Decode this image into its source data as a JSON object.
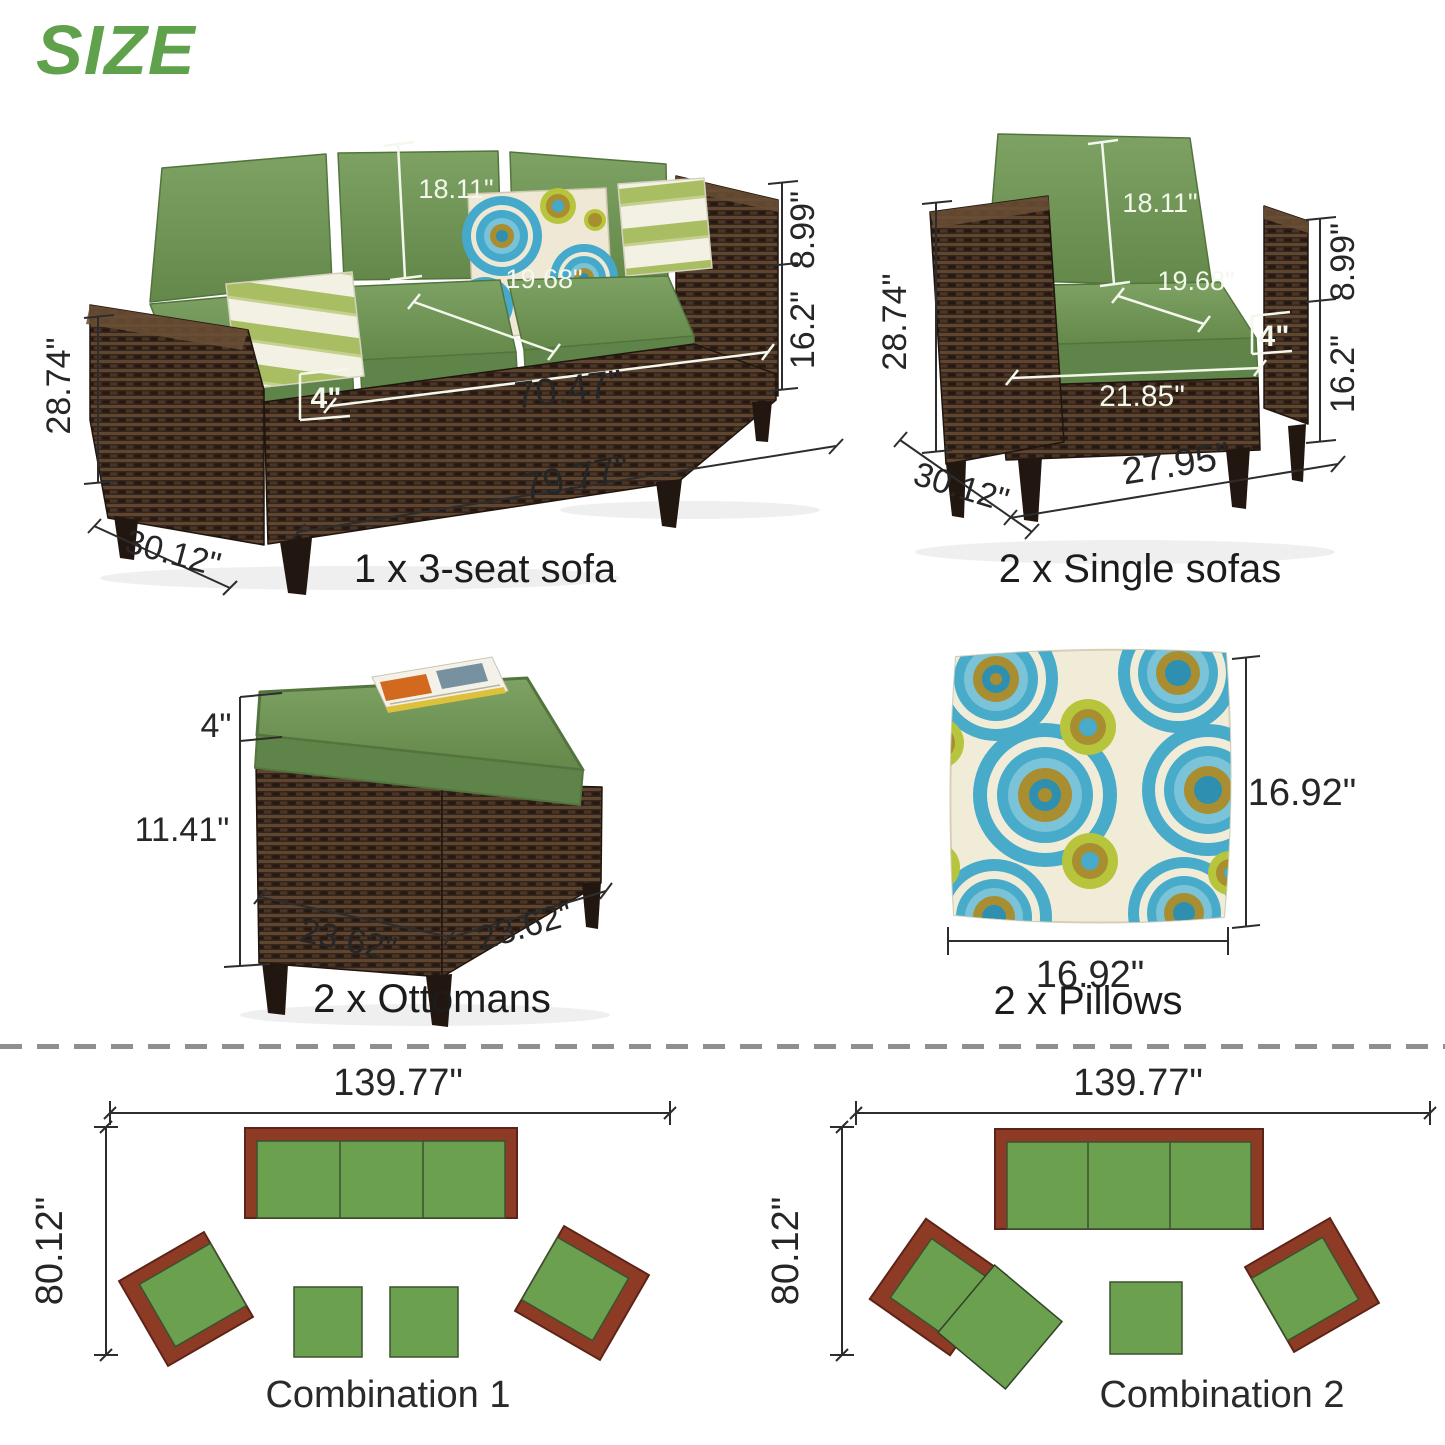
{
  "title": "SIZE",
  "colors": {
    "accent_green": "#5fa24b",
    "cushion_green": "#74975a",
    "wicker_brown": "#35251b",
    "plan_green": "#6ba04e",
    "plan_brown": "#8e3b26",
    "pillow_blue": "#47abc9"
  },
  "products": {
    "sofa3": {
      "caption": "1 x 3-seat sofa",
      "dims": {
        "back_height": "18.11\"",
        "seat_depth": "19.68\"",
        "cushion_thickness": "4\"",
        "inner_width": "70.47\"",
        "overall_width": "79.77\"",
        "arm_above_seat": "8.99\"",
        "seat_height": "16.2\"",
        "overall_height": "28.74\"",
        "overall_depth": "30.12\""
      }
    },
    "single_sofa": {
      "caption": "2 x Single sofas",
      "dims": {
        "overall_height": "28.74\"",
        "back_height": "18.11\"",
        "seat_depth": "19.68\"",
        "cushion_thickness": "4\"",
        "arm_above_seat": "8.99\"",
        "seat_height": "16.2\"",
        "seat_width": "21.85\"",
        "overall_width": "27.95\"",
        "overall_depth": "30.12\""
      }
    },
    "ottoman": {
      "caption": "2 x Ottomans",
      "dims": {
        "cushion_thickness": "4\"",
        "base_height": "11.41\"",
        "width": "23.62\"",
        "depth": "23.62\""
      }
    },
    "pillow": {
      "caption": "2 x Pillows",
      "dims": {
        "height": "16.92\"",
        "width": "16.92\""
      }
    }
  },
  "combinations": [
    {
      "label": "Combination 1",
      "width": "139.77\"",
      "depth": "80.12\""
    },
    {
      "label": "Combination 2",
      "width": "139.77\"",
      "depth": "80.12\""
    }
  ]
}
